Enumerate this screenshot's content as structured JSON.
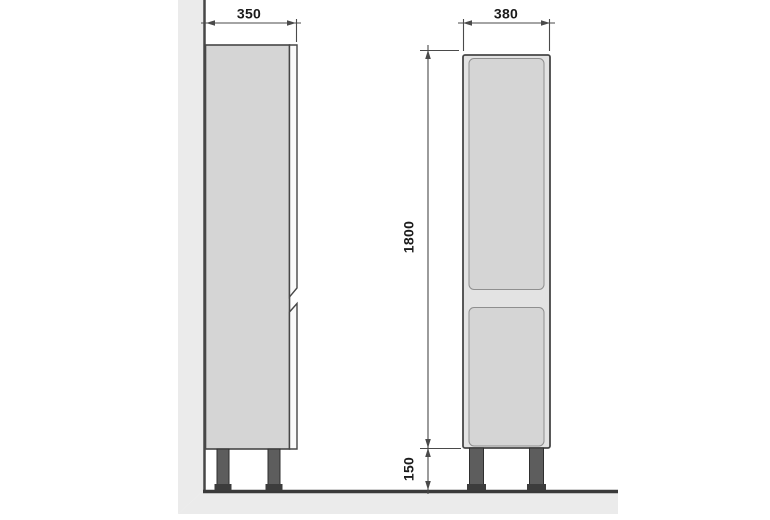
{
  "drawing": {
    "type": "furniture-technical-drawing",
    "views": {
      "side_view": "cabinet side profile against wall",
      "front_view": "cabinet front with two doors"
    }
  },
  "dimensions": {
    "side_width": "350",
    "front_width": "380",
    "body_height": "1800",
    "leg_height": "150"
  },
  "colors": {
    "background": "#ffffff",
    "line": "#474747",
    "dim": "#4a4a4a",
    "text": "#1b1b1b",
    "wall_fill": "#ebebeb",
    "floor_fill": "#ebebeb",
    "floor_line": "#3a3a3a",
    "cabinet_fill": "#d5d5d5",
    "carcass_fill": "#e3e3e3",
    "edge_strip_fill": "#fafafa",
    "door_outline": "#8f8f8f",
    "leg_fill": "#5d5d5d",
    "leg_outline": "#2f2f2f",
    "foot_fill": "#3c3c3c"
  }
}
